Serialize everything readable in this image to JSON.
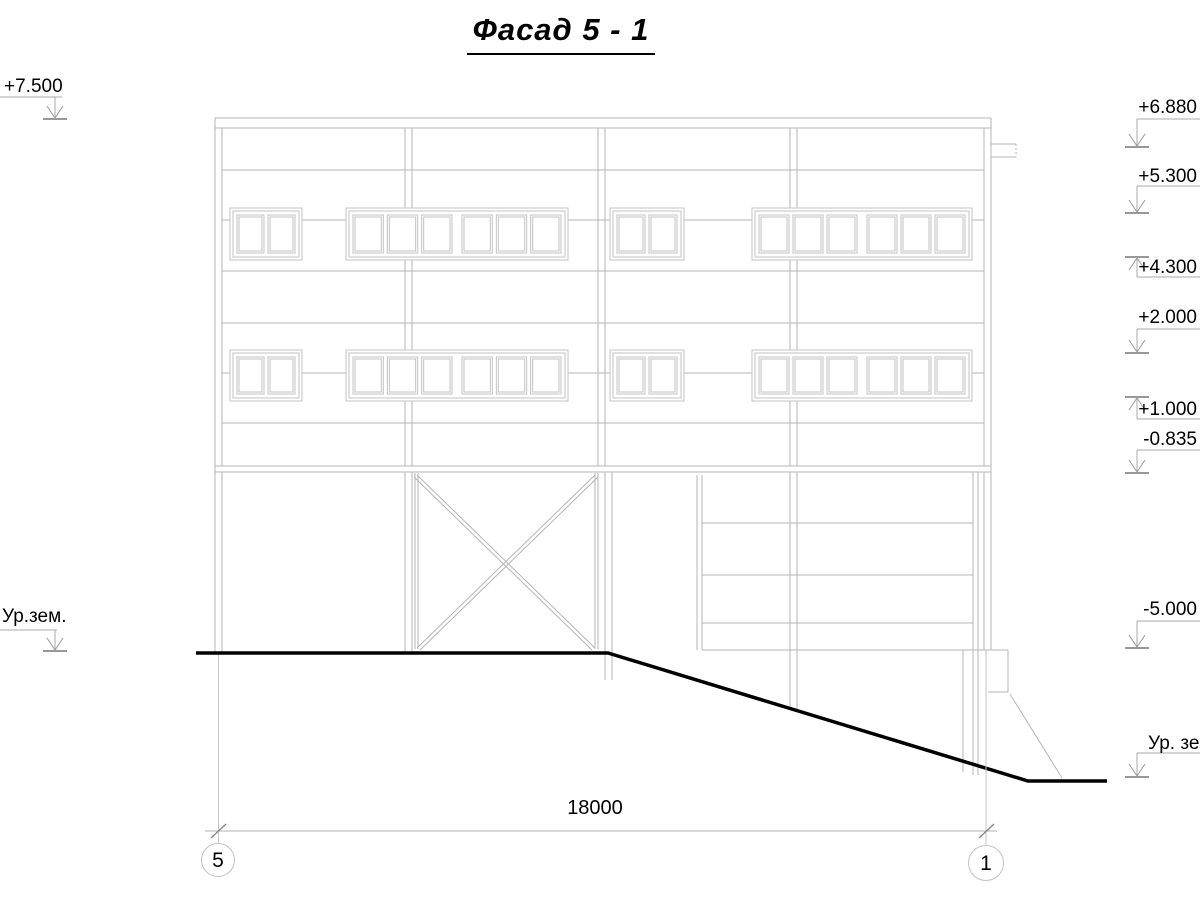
{
  "title": "Фасад 5 - 1",
  "elevation_marks": {
    "left": [
      {
        "label": "+7.500"
      },
      {
        "label": "Ур.зем."
      }
    ],
    "right": [
      {
        "label": "+6.880"
      },
      {
        "label": "+5.300"
      },
      {
        "label": "+4.300"
      },
      {
        "label": "+2.000"
      },
      {
        "label": "+1.000"
      },
      {
        "label": "-0.835"
      },
      {
        "label": "-5.000"
      },
      {
        "label": "Ур. зе"
      }
    ]
  },
  "dimension": {
    "length": "18000"
  },
  "axis_bubbles": [
    {
      "number": "5"
    },
    {
      "number": "1"
    }
  ],
  "colors": {
    "facade_line": "#b5b5b5",
    "window_line": "#c3c3c3",
    "mark_line": "#a8a8a8",
    "mark_tick": "#777777",
    "dim_line": "#b0b0b0",
    "ground": "#000000"
  }
}
